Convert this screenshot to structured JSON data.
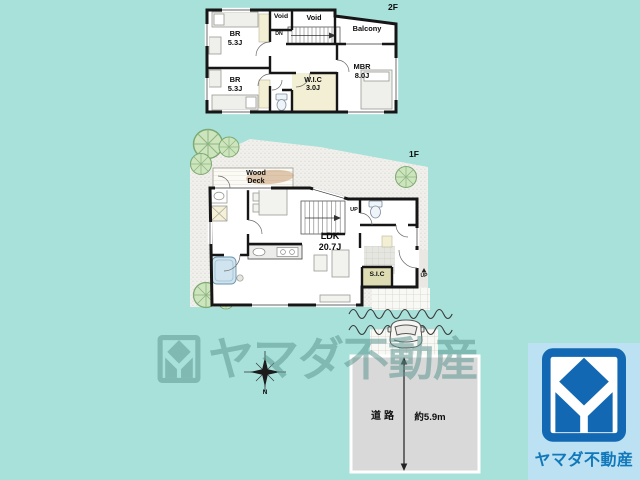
{
  "colors": {
    "background": "#a8e0da",
    "wall": "#161616",
    "site_gray": "#f1f0ec",
    "road_gray": "#d9d9d9",
    "closet_cream": "#f3efd4",
    "sic_khaki": "#dedcb2",
    "watermark_teal": "#85beb9",
    "logo_blue": "#1268b2",
    "logo_card_bg": "#bce1f2",
    "logo_text_blue": "#1179bb"
  },
  "floor2": {
    "floor_label": "2F",
    "rooms": {
      "br1": {
        "name": "BR",
        "size": "5.3J"
      },
      "br2": {
        "name": "BR",
        "size": "5.3J"
      },
      "void1": {
        "name": "Void"
      },
      "void2": {
        "name": "Void"
      },
      "balcony": {
        "name": "Balcony"
      },
      "wic": {
        "name": "W.I.C",
        "size": "3.0J"
      },
      "mbr": {
        "name": "MBR",
        "size": "8.0J"
      },
      "stairs_label": "DN"
    }
  },
  "floor1": {
    "floor_label": "1F",
    "rooms": {
      "wood_deck": {
        "name": "Wood Deck"
      },
      "ldk": {
        "name": "LDK",
        "size": "20.7J"
      },
      "sic": {
        "name": "S.I.C"
      },
      "stairs_label": "UP",
      "entrance_step_label": "UP"
    }
  },
  "site": {
    "road_label": "道路",
    "road_width": "約5.9m",
    "compass_label": "N"
  },
  "watermark": {
    "text": "ヤマダ不動産"
  },
  "logo": {
    "company_name": "ヤマダ不動産"
  }
}
